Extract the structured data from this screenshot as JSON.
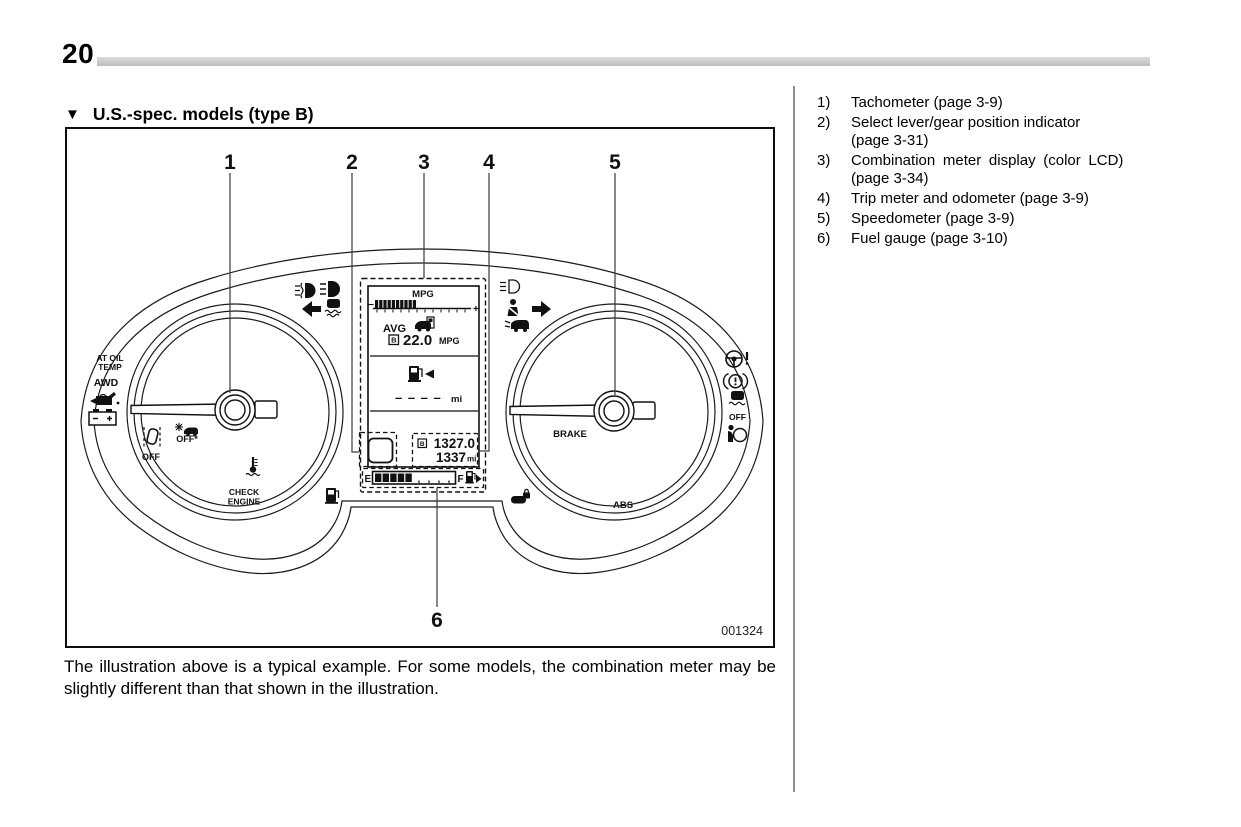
{
  "page": {
    "number": "20"
  },
  "section": {
    "marker": "▼",
    "title": "U.S.-spec. models (type B)"
  },
  "legend": {
    "items": [
      {
        "num": "1)",
        "lines": [
          "Tachometer (page 3-9)"
        ]
      },
      {
        "num": "2)",
        "lines": [
          "Select lever/gear position indicator",
          "(page 3-31)"
        ]
      },
      {
        "num": "3)",
        "lines": [
          "Combination meter display (color LCD)",
          "(page 3-34)"
        ]
      },
      {
        "num": "4)",
        "lines": [
          "Trip meter and odometer (page 3-9)"
        ]
      },
      {
        "num": "5)",
        "lines": [
          "Speedometer (page 3-9)"
        ]
      },
      {
        "num": "6)",
        "lines": [
          "Fuel gauge (page 3-10)"
        ]
      }
    ]
  },
  "caption": "The illustration above is a typical example. For some models, the combination meter may be slightly different than that shown in the illustration.",
  "figure": {
    "code": "001324",
    "callouts": {
      "c1": "1",
      "c2": "2",
      "c3": "3",
      "c4": "4",
      "c5": "5",
      "c6": "6"
    },
    "labels": {
      "at_oil_line1": "AT OIL",
      "at_oil_line2": "TEMP",
      "awd": "AWD",
      "lane_sway_off": "OFF",
      "precollision_off": "OFF*",
      "check_line1": "CHECK",
      "check_line2": "ENGINE",
      "brake": "BRAKE",
      "abs": "ABS",
      "vdc_off": "OFF"
    },
    "lcd": {
      "title": "MPG",
      "bar_minus": "−",
      "bar_plus": "+",
      "avg_label": "AVG",
      "avg_b": "B",
      "avg_value": "22.0",
      "avg_unit": "MPG",
      "range_value": "– – – –",
      "range_unit": "mi",
      "odo_b": "B",
      "odo_value": "1327.0",
      "trip_value": "1337",
      "trip_unit": "mi",
      "fuel_empty": "E",
      "fuel_full": "F"
    }
  },
  "colors": {
    "rule_gray": "#c7c7c7",
    "divider_gray": "#8f8f8f",
    "ink": "#111111"
  }
}
